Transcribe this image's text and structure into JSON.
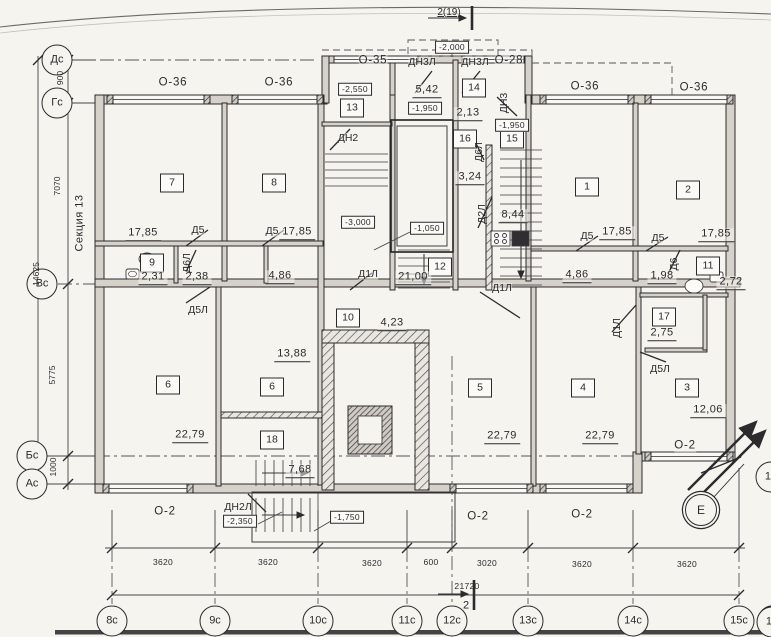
{
  "drawing": {
    "section_title": "Секция 13",
    "section_marker_top": "2(19)",
    "section_marker_bottom": "2",
    "colors": {
      "ink": "#2b2b2e",
      "paper": "#f6f4ef",
      "wall_fill": "#d6d2ca"
    }
  },
  "labels": [
    {
      "name": "axis-dc",
      "text": "Дс",
      "x": 57,
      "y": 60,
      "cls": "axis"
    },
    {
      "name": "axis-gc",
      "text": "Гс",
      "x": 57,
      "y": 103,
      "cls": "axis"
    },
    {
      "name": "axis-vc",
      "text": "Вс",
      "x": 42,
      "y": 284,
      "cls": "axis"
    },
    {
      "name": "axis-bc",
      "text": "Бс",
      "x": 32,
      "y": 456,
      "cls": "axis"
    },
    {
      "name": "axis-ac",
      "text": "Ас",
      "x": 32,
      "y": 484,
      "cls": "axis"
    },
    {
      "name": "axis-8c",
      "text": "8с",
      "x": 112,
      "y": 621,
      "cls": "axis"
    },
    {
      "name": "axis-9c",
      "text": "9с",
      "x": 215,
      "y": 621,
      "cls": "axis"
    },
    {
      "name": "axis-10c",
      "text": "10с",
      "x": 318,
      "y": 621,
      "cls": "axis"
    },
    {
      "name": "axis-11c",
      "text": "11с",
      "x": 407,
      "y": 621,
      "cls": "axis"
    },
    {
      "name": "axis-12c",
      "text": "12с",
      "x": 452,
      "y": 621,
      "cls": "axis"
    },
    {
      "name": "axis-13c",
      "text": "13с",
      "x": 528,
      "y": 621,
      "cls": "axis"
    },
    {
      "name": "axis-14c",
      "text": "14с",
      "x": 633,
      "y": 621,
      "cls": "axis"
    },
    {
      "name": "axis-15c",
      "text": "15с",
      "x": 739,
      "y": 621,
      "cls": "axis"
    },
    {
      "name": "axis-15-partial-bottom",
      "text": "15",
      "x": 772,
      "y": 622,
      "cls": "axis"
    },
    {
      "name": "axis-e",
      "text": "Е",
      "x": 701,
      "y": 510,
      "cls": "axis-e"
    },
    {
      "name": "axis-15-partial-cut",
      "text": "15",
      "x": 771,
      "y": 477,
      "cls": "axis"
    },
    {
      "name": "room-7",
      "text": "7",
      "x": 172,
      "y": 183,
      "cls": "room"
    },
    {
      "name": "room-8",
      "text": "8",
      "x": 274,
      "y": 183,
      "cls": "room"
    },
    {
      "name": "room-13",
      "text": "13",
      "x": 352,
      "y": 108,
      "cls": "room"
    },
    {
      "name": "room-14",
      "text": "14",
      "x": 474,
      "y": 88,
      "cls": "room"
    },
    {
      "name": "room-16",
      "text": "16",
      "x": 465,
      "y": 139,
      "cls": "room"
    },
    {
      "name": "room-15",
      "text": "15",
      "x": 512,
      "y": 139,
      "cls": "room"
    },
    {
      "name": "room-1",
      "text": "1",
      "x": 587,
      "y": 187,
      "cls": "room"
    },
    {
      "name": "room-2",
      "text": "2",
      "x": 688,
      "y": 190,
      "cls": "room"
    },
    {
      "name": "room-9",
      "text": "9",
      "x": 152,
      "y": 263,
      "cls": "room"
    },
    {
      "name": "room-12",
      "text": "12",
      "x": 440,
      "y": 267,
      "cls": "room"
    },
    {
      "name": "room-10",
      "text": "10",
      "x": 348,
      "y": 318,
      "cls": "room"
    },
    {
      "name": "room-11",
      "text": "11",
      "x": 708,
      "y": 266,
      "cls": "room"
    },
    {
      "name": "room-17",
      "text": "17",
      "x": 664,
      "y": 317,
      "cls": "room"
    },
    {
      "name": "room-6a",
      "text": "6",
      "x": 168,
      "y": 385,
      "cls": "room"
    },
    {
      "name": "room-6b",
      "text": "6",
      "x": 272,
      "y": 387,
      "cls": "room"
    },
    {
      "name": "room-18",
      "text": "18",
      "x": 272,
      "y": 440,
      "cls": "room"
    },
    {
      "name": "room-5",
      "text": "5",
      "x": 480,
      "y": 388,
      "cls": "room"
    },
    {
      "name": "room-4",
      "text": "4",
      "x": 583,
      "y": 388,
      "cls": "room"
    },
    {
      "name": "room-3",
      "text": "3",
      "x": 687,
      "y": 388,
      "cls": "room"
    },
    {
      "name": "area-7",
      "text": "17,85",
      "x": 143,
      "y": 234,
      "cls": "area"
    },
    {
      "name": "area-8",
      "text": "17,85",
      "x": 297,
      "y": 233,
      "cls": "area"
    },
    {
      "name": "area-9",
      "text": "2,31",
      "x": 153,
      "y": 278,
      "cls": "area"
    },
    {
      "name": "area-closet-left",
      "text": "2,38",
      "x": 197,
      "y": 278,
      "cls": "area"
    },
    {
      "name": "area-hall-left",
      "text": "4,86",
      "x": 280,
      "y": 277,
      "cls": "area"
    },
    {
      "name": "area-lobby",
      "text": "5,42",
      "x": 427,
      "y": 91,
      "cls": "area"
    },
    {
      "name": "area-tambour",
      "text": "2,13",
      "x": 468,
      "y": 114,
      "cls": "area"
    },
    {
      "name": "area-stair",
      "text": "3,24",
      "x": 470,
      "y": 178,
      "cls": "area"
    },
    {
      "name": "area-corr-right",
      "text": "8,44",
      "x": 513,
      "y": 216,
      "cls": "area"
    },
    {
      "name": "area-corridor",
      "text": "21,00",
      "x": 413,
      "y": 278,
      "cls": "area"
    },
    {
      "name": "area-bath-10",
      "text": "4,23",
      "x": 392,
      "y": 324,
      "cls": "area"
    },
    {
      "name": "area-6b",
      "text": "13,88",
      "x": 292,
      "y": 355,
      "cls": "area"
    },
    {
      "name": "area-6a",
      "text": "22,79",
      "x": 190,
      "y": 436,
      "cls": "area"
    },
    {
      "name": "area-18",
      "text": "7,68",
      "x": 300,
      "y": 471,
      "cls": "area"
    },
    {
      "name": "area-hall-right",
      "text": "4,86",
      "x": 577,
      "y": 276,
      "cls": "area"
    },
    {
      "name": "area-1",
      "text": "17,85",
      "x": 617,
      "y": 233,
      "cls": "area"
    },
    {
      "name": "area-2",
      "text": "17,85",
      "x": 716,
      "y": 235,
      "cls": "area"
    },
    {
      "name": "area-closet-right",
      "text": "1,98",
      "x": 662,
      "y": 277,
      "cls": "area"
    },
    {
      "name": "area-bath-11",
      "text": "2,72",
      "x": 731,
      "y": 283,
      "cls": "area"
    },
    {
      "name": "area-17",
      "text": "2,75",
      "x": 662,
      "y": 334,
      "cls": "area"
    },
    {
      "name": "area-3",
      "text": "12,06",
      "x": 708,
      "y": 411,
      "cls": "area"
    },
    {
      "name": "area-5",
      "text": "22,79",
      "x": 502,
      "y": 437,
      "cls": "area"
    },
    {
      "name": "area-4",
      "text": "22,79",
      "x": 600,
      "y": 437,
      "cls": "area"
    },
    {
      "name": "elev-porch-top",
      "text": "-2,000",
      "x": 452,
      "y": 47,
      "cls": "elev"
    },
    {
      "name": "elev-2550",
      "text": "-2,550",
      "x": 355,
      "y": 89,
      "cls": "elev"
    },
    {
      "name": "elev-1950-left",
      "text": "-1,950",
      "x": 425,
      "y": 108,
      "cls": "elev"
    },
    {
      "name": "elev-1950-right",
      "text": "-1,950",
      "x": 512,
      "y": 125,
      "cls": "elev"
    },
    {
      "name": "elev-3000",
      "text": "-3,000",
      "x": 358,
      "y": 222,
      "cls": "elev"
    },
    {
      "name": "elev-1050",
      "text": "-1,050",
      "x": 427,
      "y": 228,
      "cls": "elev"
    },
    {
      "name": "elev-2350",
      "text": "-2,350",
      "x": 240,
      "y": 521,
      "cls": "elev"
    },
    {
      "name": "elev-1750",
      "text": "-1,750",
      "x": 347,
      "y": 517,
      "cls": "elev"
    },
    {
      "name": "door-dn2",
      "text": "ДН2",
      "x": 348,
      "y": 138,
      "cls": "door"
    },
    {
      "name": "door-dn3l-1",
      "text": "ДН3Л",
      "x": 422,
      "y": 62,
      "cls": "door"
    },
    {
      "name": "door-dn3l-2",
      "text": "ДН3Л",
      "x": 475,
      "y": 62,
      "cls": "door"
    },
    {
      "name": "door-dn3",
      "text": "ДН3",
      "x": 504,
      "y": 103,
      "cls": "door-v"
    },
    {
      "name": "door-d6l-stair",
      "text": "Д6Л",
      "x": 479,
      "y": 152,
      "cls": "door-v"
    },
    {
      "name": "door-dn2l",
      "text": "ДН2Л",
      "x": 238,
      "y": 507,
      "cls": "door"
    },
    {
      "name": "door-d5-1",
      "text": "Д5",
      "x": 198,
      "y": 230,
      "cls": "door"
    },
    {
      "name": "door-d5-2",
      "text": "Д5",
      "x": 272,
      "y": 231,
      "cls": "door"
    },
    {
      "name": "door-d5-3",
      "text": "Д5",
      "x": 587,
      "y": 236,
      "cls": "door"
    },
    {
      "name": "door-d5-4",
      "text": "Д5",
      "x": 658,
      "y": 238,
      "cls": "door"
    },
    {
      "name": "door-d5l-1",
      "text": "Д5Л",
      "x": 198,
      "y": 310,
      "cls": "door"
    },
    {
      "name": "door-d5l-2",
      "text": "Д5Л",
      "x": 660,
      "y": 369,
      "cls": "door"
    },
    {
      "name": "door-d6l",
      "text": "Д6Л",
      "x": 187,
      "y": 263,
      "cls": "door-v"
    },
    {
      "name": "door-d6",
      "text": "Д6",
      "x": 674,
      "y": 264,
      "cls": "door-v"
    },
    {
      "name": "door-d1l-1",
      "text": "Д1Л",
      "x": 368,
      "y": 274,
      "cls": "door"
    },
    {
      "name": "door-d1l-2",
      "text": "Д1Л",
      "x": 502,
      "y": 288,
      "cls": "door"
    },
    {
      "name": "door-d1l-3",
      "text": "Д1Л",
      "x": 617,
      "y": 328,
      "cls": "door-v"
    },
    {
      "name": "door-d2l",
      "text": "Д2Л",
      "x": 482,
      "y": 214,
      "cls": "door-v"
    },
    {
      "name": "win-o36-1",
      "text": "О-36",
      "x": 173,
      "y": 83,
      "cls": "win"
    },
    {
      "name": "win-o36-2",
      "text": "О-36",
      "x": 279,
      "y": 83,
      "cls": "win"
    },
    {
      "name": "win-o35",
      "text": "О-35",
      "x": 373,
      "y": 61,
      "cls": "win"
    },
    {
      "name": "win-o28",
      "text": "О-28",
      "x": 509,
      "y": 61,
      "cls": "win"
    },
    {
      "name": "win-o36-3",
      "text": "О-36",
      "x": 585,
      "y": 87,
      "cls": "win"
    },
    {
      "name": "win-o36-4",
      "text": "О-36",
      "x": 694,
      "y": 88,
      "cls": "win"
    },
    {
      "name": "win-o2-1",
      "text": "О-2",
      "x": 165,
      "y": 512,
      "cls": "win"
    },
    {
      "name": "win-o2-2",
      "text": "О-2",
      "x": 478,
      "y": 517,
      "cls": "win"
    },
    {
      "name": "win-o2-3",
      "text": "О-2",
      "x": 582,
      "y": 515,
      "cls": "win"
    },
    {
      "name": "win-o2-4",
      "text": "О-2",
      "x": 685,
      "y": 446,
      "cls": "win"
    },
    {
      "name": "dim-3620-1",
      "text": "3620",
      "x": 163,
      "y": 562,
      "cls": "dim"
    },
    {
      "name": "dim-3620-2",
      "text": "3620",
      "x": 268,
      "y": 562,
      "cls": "dim"
    },
    {
      "name": "dim-3620-3",
      "text": "3620",
      "x": 372,
      "y": 563,
      "cls": "dim"
    },
    {
      "name": "dim-600",
      "text": "600",
      "x": 431,
      "y": 562,
      "cls": "dim"
    },
    {
      "name": "dim-3020",
      "text": "3020",
      "x": 487,
      "y": 563,
      "cls": "dim"
    },
    {
      "name": "dim-3620-4",
      "text": "3620",
      "x": 582,
      "y": 564,
      "cls": "dim"
    },
    {
      "name": "dim-3620-5",
      "text": "3620",
      "x": 687,
      "y": 564,
      "cls": "dim"
    },
    {
      "name": "dim-21720",
      "text": "21720",
      "x": 467,
      "y": 586,
      "cls": "dim"
    },
    {
      "name": "dim-900",
      "text": "900",
      "x": 60,
      "y": 78,
      "cls": "dim-v"
    },
    {
      "name": "dim-7070",
      "text": "7070",
      "x": 57,
      "y": 186,
      "cls": "dim-v"
    },
    {
      "name": "dim-14625",
      "text": "14625",
      "x": 36,
      "y": 274,
      "cls": "dim-v"
    },
    {
      "name": "dim-5775",
      "text": "5775",
      "x": 52,
      "y": 375,
      "cls": "dim-v"
    },
    {
      "name": "dim-1000",
      "text": "1000",
      "x": 53,
      "y": 467,
      "cls": "dim-v"
    },
    {
      "name": "section-title",
      "text": "Секция 13",
      "x": 80,
      "y": 223,
      "cls": "note-v"
    },
    {
      "name": "section-marker-top",
      "text": "2(19)",
      "x": 449,
      "y": 13,
      "cls": "sec"
    },
    {
      "name": "section-marker-bottom",
      "text": "2",
      "x": 466,
      "y": 606,
      "cls": "sec2"
    }
  ]
}
